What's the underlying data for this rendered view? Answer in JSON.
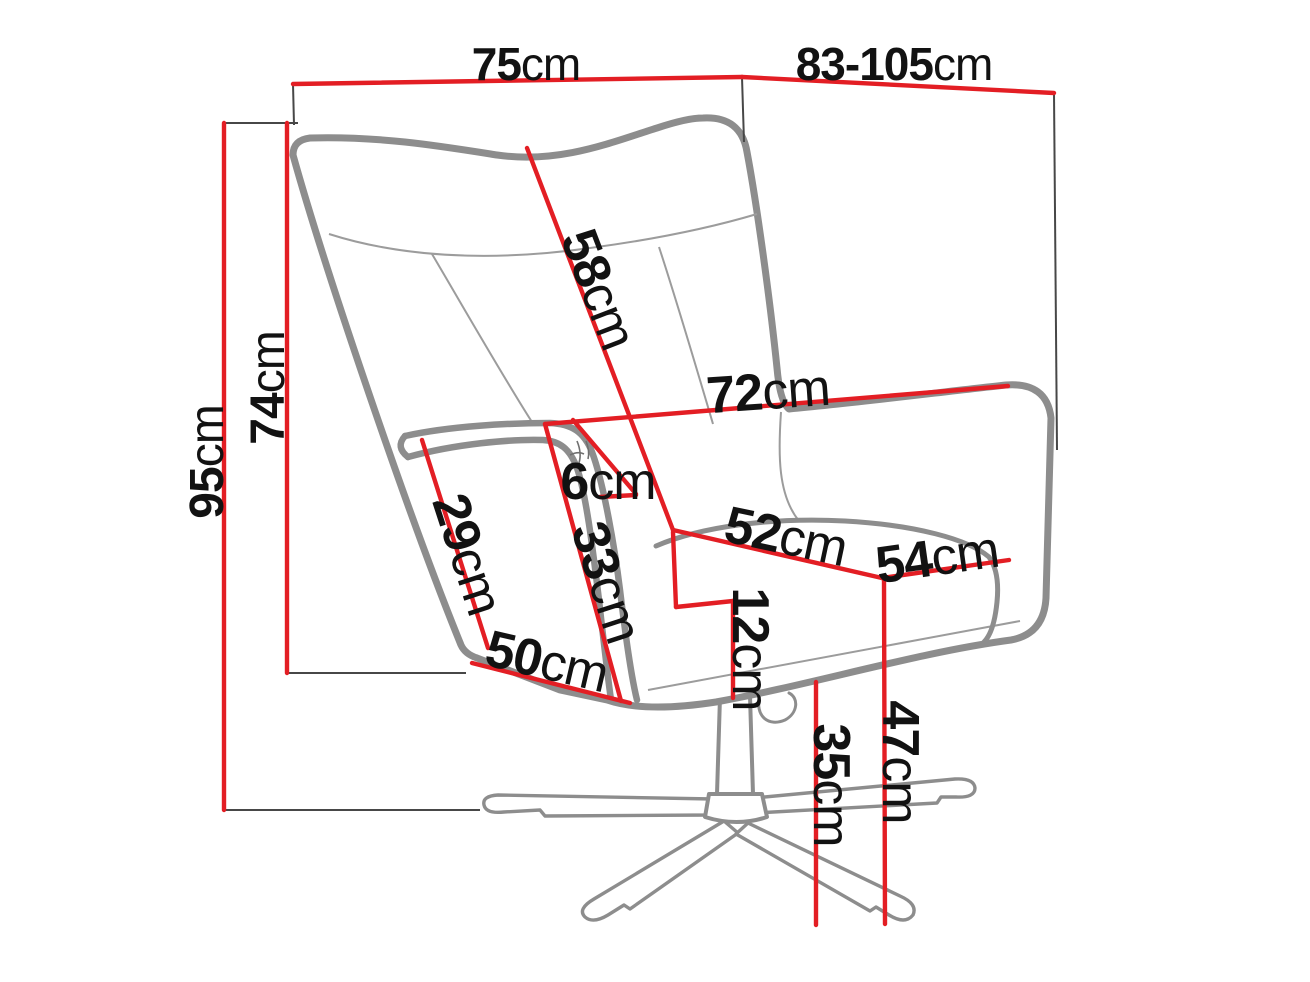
{
  "diagram": {
    "type": "furniture-dimension-drawing",
    "subject": "swivel wingback armchair with star base",
    "unit": "cm",
    "colors": {
      "dimension_red": "#e31e24",
      "outline_gray": "#8d8d8d",
      "seam_gray": "#9c9c9c",
      "extension_black": "#474747",
      "label_black": "#121212"
    },
    "dimensions": [
      {
        "name": "overall-width",
        "value": "75",
        "unit": "cm"
      },
      {
        "name": "overall-depth-range",
        "value": "83-105",
        "unit": "cm"
      },
      {
        "name": "overall-height",
        "value": "95",
        "unit": "cm"
      },
      {
        "name": "backrest-height",
        "value": "74",
        "unit": "cm"
      },
      {
        "name": "backrest-length",
        "value": "58",
        "unit": "cm"
      },
      {
        "name": "width-between-arms",
        "value": "72",
        "unit": "cm"
      },
      {
        "name": "armrest-top-thickness",
        "value": "6",
        "unit": "cm"
      },
      {
        "name": "armrest-inner-height",
        "value": "33",
        "unit": "cm"
      },
      {
        "name": "side-front-height",
        "value": "29",
        "unit": "cm"
      },
      {
        "name": "side-base-length",
        "value": "50",
        "unit": "cm"
      },
      {
        "name": "seat-front-width",
        "value": "52",
        "unit": "cm"
      },
      {
        "name": "seat-side-depth",
        "value": "54",
        "unit": "cm"
      },
      {
        "name": "seat-cushion-thickness",
        "value": "12",
        "unit": "cm"
      },
      {
        "name": "under-seat-clearance",
        "value": "35",
        "unit": "cm"
      },
      {
        "name": "seat-height",
        "value": "47",
        "unit": "cm"
      }
    ]
  }
}
